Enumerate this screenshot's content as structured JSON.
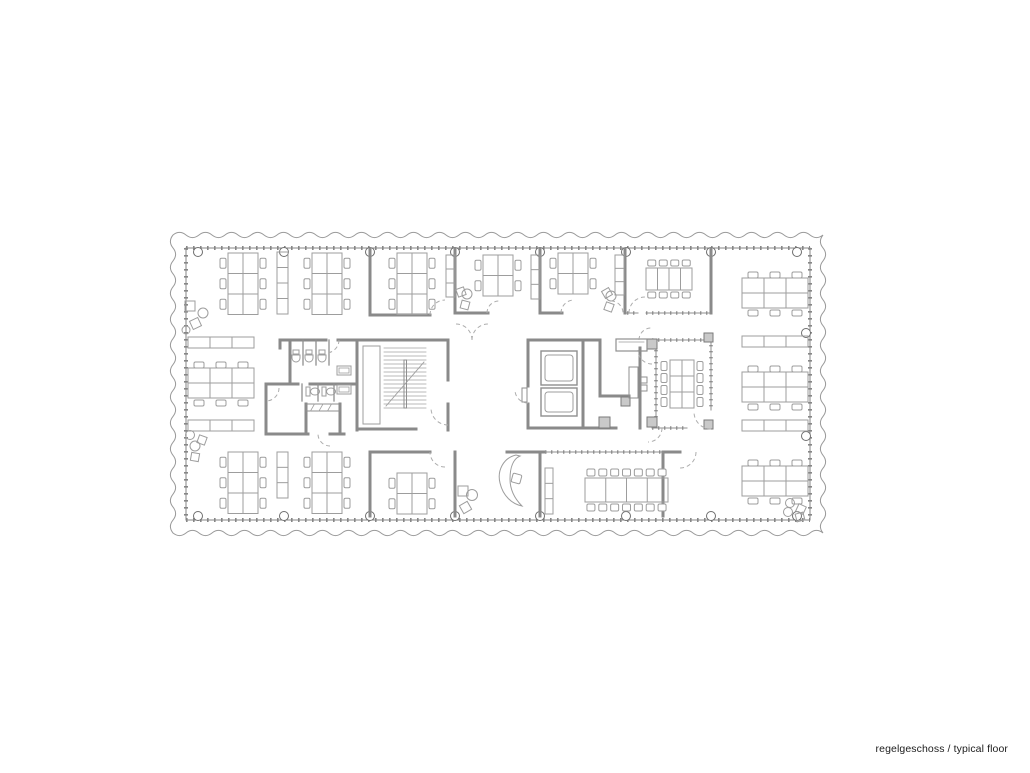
{
  "caption": {
    "text": "regelgeschoss / typical floor"
  },
  "colors": {
    "background": "#ffffff",
    "wall": "#8a8a8a",
    "boundary": "#868686",
    "glass": "#8f8f8f",
    "furniture": "#9d9d9d",
    "fixture": "#9d9d9d",
    "column": "#6e6e6e",
    "dash": "#adadad",
    "wave": "#9a9a9a",
    "post_fill": "#c9c9c9",
    "text": "#1c1c1c"
  },
  "plan": {
    "boundary": {
      "x": 186,
      "y": 248,
      "w": 624,
      "h": 272
    },
    "wave": {
      "x0": 173,
      "y0": 235,
      "x1": 823,
      "y1": 533,
      "wavelength": 13,
      "amplitude": 2.6
    },
    "columns": {
      "xs": [
        198,
        284,
        370,
        455,
        540,
        626,
        711,
        797
      ],
      "y_top": 252,
      "y_bottom": 516,
      "side": [
        [
          806,
          333
        ],
        [
          806,
          436
        ]
      ],
      "r": 4.5
    },
    "walls": [
      [
        370,
        249,
        370,
        315
      ],
      [
        455,
        249,
        455,
        313
      ],
      [
        540,
        249,
        540,
        313
      ],
      [
        625,
        249,
        625,
        313
      ],
      [
        711,
        249,
        711,
        313
      ],
      [
        370,
        315,
        430,
        315
      ],
      [
        455,
        313,
        488,
        313
      ],
      [
        540,
        313,
        562,
        313
      ],
      [
        280,
        340,
        326,
        340
      ],
      [
        338,
        340,
        357,
        340
      ],
      [
        280,
        340,
        280,
        348
      ],
      [
        290,
        340,
        290,
        384
      ],
      [
        266,
        384,
        298,
        384
      ],
      [
        310,
        384,
        357,
        384
      ],
      [
        266,
        384,
        266,
        434
      ],
      [
        266,
        434,
        308,
        434
      ],
      [
        330,
        434,
        344,
        434
      ],
      [
        306,
        404,
        306,
        434
      ],
      [
        340,
        404,
        340,
        434
      ],
      [
        357,
        340,
        357,
        430
      ],
      [
        357,
        340,
        448,
        340
      ],
      [
        448,
        340,
        448,
        380
      ],
      [
        448,
        404,
        448,
        430
      ],
      [
        357,
        429,
        416,
        429
      ],
      [
        528,
        340,
        600,
        340
      ],
      [
        528,
        340,
        528,
        386
      ],
      [
        528,
        404,
        528,
        428
      ],
      [
        528,
        428,
        583,
        428
      ],
      [
        583,
        342,
        583,
        428
      ],
      [
        600,
        342,
        600,
        396
      ],
      [
        600,
        396,
        629,
        396
      ],
      [
        583,
        428,
        616,
        428
      ],
      [
        640,
        348,
        640,
        428
      ],
      [
        370,
        452,
        370,
        516
      ],
      [
        370,
        452,
        430,
        452
      ],
      [
        455,
        452,
        455,
        516
      ],
      [
        507,
        452,
        545,
        452
      ],
      [
        540,
        452,
        540,
        516
      ],
      [
        663,
        452,
        663,
        516
      ],
      [
        663,
        452,
        680,
        452
      ]
    ],
    "glass": [
      [
        646,
        313,
        711,
        313
      ],
      [
        627,
        313,
        638,
        313
      ],
      [
        652,
        340,
        705,
        340
      ],
      [
        656,
        350,
        656,
        417
      ],
      [
        711,
        333,
        711,
        410
      ],
      [
        652,
        428,
        687,
        428
      ],
      [
        545,
        452,
        663,
        452
      ]
    ],
    "posts": [
      [
        647,
        339,
        10
      ],
      [
        647,
        417,
        10
      ],
      [
        704,
        333,
        9
      ],
      [
        704,
        420,
        9
      ],
      [
        599,
        417,
        11
      ],
      [
        621,
        397,
        9
      ]
    ],
    "v_clusters": [
      [
        228,
        253,
        3
      ],
      [
        312,
        253,
        3
      ],
      [
        397,
        253,
        3
      ],
      [
        483,
        255,
        2
      ],
      [
        558,
        253,
        2
      ],
      [
        228,
        452,
        3
      ],
      [
        312,
        452,
        3
      ],
      [
        397,
        473,
        2
      ]
    ],
    "h_clusters": [
      [
        188,
        362,
        3
      ],
      [
        742,
        272,
        3
      ],
      [
        742,
        366,
        3
      ],
      [
        742,
        460,
        3
      ]
    ],
    "shelves_v": [
      [
        277,
        252,
        11,
        62,
        4
      ],
      [
        446,
        255,
        9,
        42,
        3
      ],
      [
        531,
        255,
        9,
        44,
        3
      ],
      [
        615,
        255,
        9,
        40,
        3
      ],
      [
        277,
        452,
        11,
        46,
        3
      ],
      [
        545,
        468,
        8,
        46,
        3
      ]
    ],
    "shelves_h": [
      [
        188,
        337,
        66,
        11,
        3
      ],
      [
        188,
        420,
        66,
        11,
        3
      ],
      [
        742,
        336,
        66,
        11,
        3
      ],
      [
        742,
        420,
        66,
        11,
        3
      ]
    ],
    "stairs": {
      "x1": 384,
      "x2": 426,
      "y1": 348,
      "y2": 408,
      "step": 4,
      "divider": [
        404,
        360,
        2.5,
        48
      ],
      "diag": [
        386,
        406,
        424,
        362
      ],
      "shaft": [
        363,
        346,
        17,
        78
      ]
    },
    "elevator_cars": [
      [
        541,
        351,
        36,
        34
      ],
      [
        541,
        388,
        36,
        28
      ]
    ],
    "counter": [
      616,
      339,
      31,
      12
    ],
    "cabinets": [
      [
        629,
        367,
        9,
        31
      ],
      [
        641,
        377,
        6,
        6
      ],
      [
        641,
        385,
        6,
        6
      ],
      [
        522,
        388,
        5,
        14
      ]
    ],
    "toilet": {
      "urinals": [
        296,
        309,
        322
      ],
      "urinal_y": 350,
      "partitions": [
        [
          303,
          340,
          303,
          365
        ],
        [
          316,
          340,
          316,
          365
        ],
        [
          329,
          340,
          329,
          365
        ],
        [
          302,
          384,
          302,
          401
        ],
        [
          318,
          384,
          318,
          401
        ],
        [
          334,
          384,
          334,
          401
        ]
      ],
      "stall_toilets": [
        [
          306,
          387
        ],
        [
          322,
          387
        ]
      ],
      "sinks": [
        [
          337,
          366
        ],
        [
          337,
          385
        ]
      ],
      "shelf": [
        306,
        404,
        34,
        7
      ]
    },
    "tables": {
      "top_meeting": {
        "x": 646,
        "y": 268,
        "w": 46,
        "h": 22,
        "cols": 4,
        "chairs": 4
      },
      "mid_meeting": {
        "x": 670,
        "y": 360,
        "w": 24,
        "h": 48,
        "rows": 3,
        "chairs": 4
      },
      "conference": {
        "x": 585,
        "y": 478,
        "w": 83,
        "h": 24,
        "cols": 4,
        "chairs": 7
      }
    },
    "curved_desk": {
      "path": "M 516 455 C 503 458 497 471 500 483 C 503 496 512 504 522 506 C 515 499 510 490 510 479 C 510 468 513 459 520 456 Z",
      "chair": [
        512,
        474,
        9,
        15
      ]
    },
    "lounges": [
      {
        "items": [
          [
            "s",
            185,
            301,
            10,
            0
          ],
          [
            "c",
            203,
            313,
            5
          ],
          [
            "s",
            191,
            319,
            9,
            -25
          ],
          [
            "c",
            186,
            330,
            4
          ]
        ]
      },
      {
        "items": [
          [
            "c",
            190,
            435,
            4.5
          ],
          [
            "s",
            198,
            436,
            8,
            20
          ],
          [
            "c",
            195,
            446,
            5
          ],
          [
            "s",
            191,
            453,
            8,
            10
          ]
        ]
      },
      {
        "items": [
          [
            "s",
            457,
            288,
            8,
            -20
          ],
          [
            "c",
            467,
            294,
            5
          ],
          [
            "s",
            461,
            301,
            8,
            15
          ]
        ]
      },
      {
        "items": [
          [
            "s",
            603,
            289,
            8,
            -30
          ],
          [
            "c",
            611,
            296,
            5
          ],
          [
            "s",
            605,
            303,
            8,
            20
          ]
        ]
      },
      {
        "items": [
          [
            "s",
            458,
            486,
            10,
            0
          ],
          [
            "c",
            472,
            495,
            5.5
          ],
          [
            "s",
            461,
            503,
            9,
            -30
          ]
        ]
      },
      {
        "items": [
          [
            "c",
            790,
            503,
            4.5
          ],
          [
            "s",
            797,
            505,
            8,
            25
          ],
          [
            "c",
            788,
            512,
            4.5
          ],
          [
            "s",
            796,
            513,
            8,
            -15
          ]
        ]
      }
    ],
    "arcs": [
      [
        445,
        315,
        15,
        180,
        270
      ],
      [
        499,
        313,
        12,
        180,
        270
      ],
      [
        574,
        313,
        13,
        180,
        270
      ],
      [
        611,
        313,
        12,
        270,
        360
      ],
      [
        645,
        313,
        16,
        180,
        270
      ],
      [
        326,
        340,
        13,
        0,
        90
      ],
      [
        266,
        388,
        13,
        0,
        90
      ],
      [
        330,
        434,
        12,
        90,
        180
      ],
      [
        448,
        408,
        17,
        90,
        180
      ],
      [
        456,
        340,
        16,
        270,
        360
      ],
      [
        488,
        340,
        16,
        180,
        270
      ],
      [
        528,
        390,
        13,
        90,
        180
      ],
      [
        651,
        340,
        12,
        180,
        270
      ],
      [
        648,
        428,
        14,
        0,
        90
      ],
      [
        711,
        412,
        17,
        90,
        180
      ],
      [
        652,
        350,
        14,
        90,
        180
      ],
      [
        445,
        452,
        15,
        90,
        180
      ],
      [
        680,
        452,
        16,
        0,
        90
      ]
    ]
  }
}
